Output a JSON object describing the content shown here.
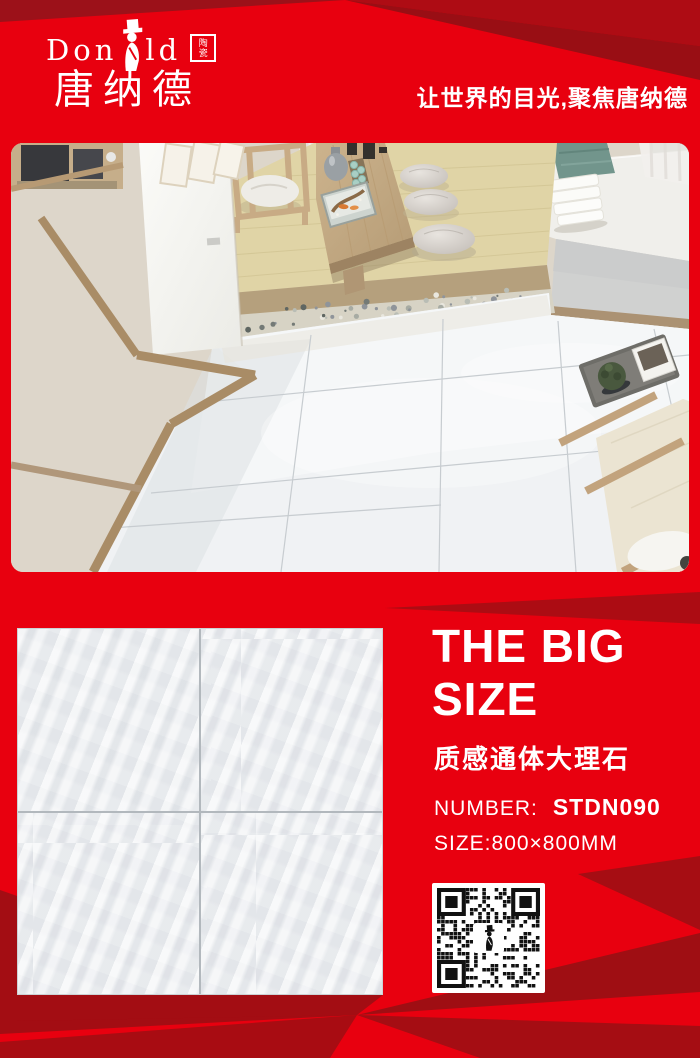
{
  "brand": {
    "wordmark_left": "Don",
    "wordmark_right": "ld",
    "badge_top": "陶",
    "badge_bottom": "瓷",
    "chinese_name": "唐纳德",
    "slogan": "让世界的目光,聚焦唐纳德"
  },
  "product": {
    "headline_line1": "THE BIG",
    "headline_line2": "SIZE",
    "subtitle_cn": "质感通体大理石",
    "number_label": "NUMBER:",
    "number_value": "STDN090",
    "size_label": "SIZE:800×800MM"
  },
  "colors": {
    "base_red": "#e8000f",
    "dark_red": "#a30d13",
    "deep_red": "#9c1119",
    "corner_red": "#ae0c14",
    "text_white": "#ffffff",
    "qr_black": "#111111"
  }
}
